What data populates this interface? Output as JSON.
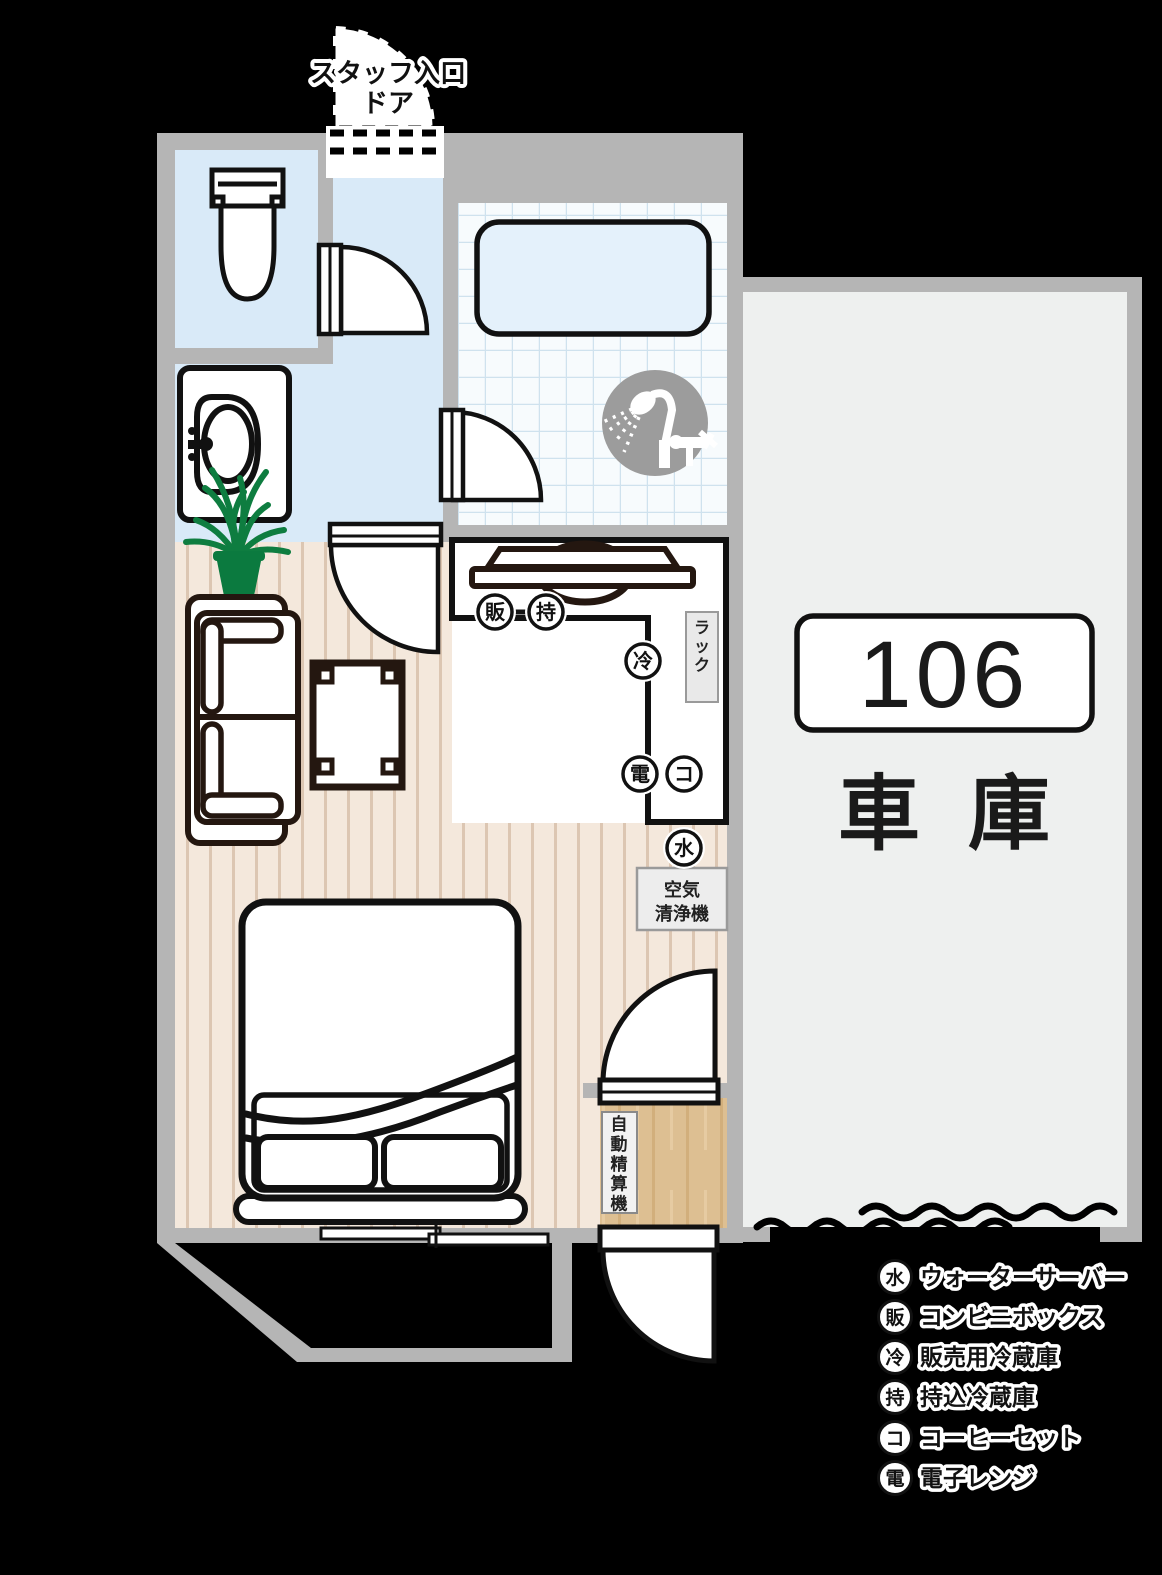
{
  "staff_entrance": {
    "label_line1": "スタッフ入口",
    "label_line2": "ドア"
  },
  "garage": {
    "room_number": "106",
    "name": "車庫"
  },
  "living_area": {
    "rack_label": "ラック",
    "air_purifier_line1": "空気",
    "air_purifier_line2": "清浄機"
  },
  "entry": {
    "payment_machine": "自動精算機"
  },
  "legend": [
    {
      "code": "水",
      "label": "ウォーターサーバー"
    },
    {
      "code": "販",
      "label": "コンビニボックス"
    },
    {
      "code": "冷",
      "label": "販売用冷蔵庫"
    },
    {
      "code": "持",
      "label": "持込冷蔵庫"
    },
    {
      "code": "コ",
      "label": "コーヒーセット"
    },
    {
      "code": "電",
      "label": "電子レンジ"
    }
  ],
  "colors": {
    "background": "#000000",
    "wall_gray": "#b5b5b5",
    "outline_black": "#111111",
    "water_blue_floor": "#d9eaf8",
    "tile_background": "#f7fbfd",
    "tile_grid": "#cfe2ee",
    "bathtub_fill": "#e4f1fb",
    "wood_floor": "#f4e8dc",
    "wood_stripe": "#dcc6b2",
    "furniture_line": "#241710",
    "plant_green": "#0e7d40",
    "vestibule_wood": "#ddbf92",
    "garage_floor": "#eef0ef",
    "shower_circle_gray": "#9c9c9c",
    "label_box_gray": "#ededed"
  }
}
